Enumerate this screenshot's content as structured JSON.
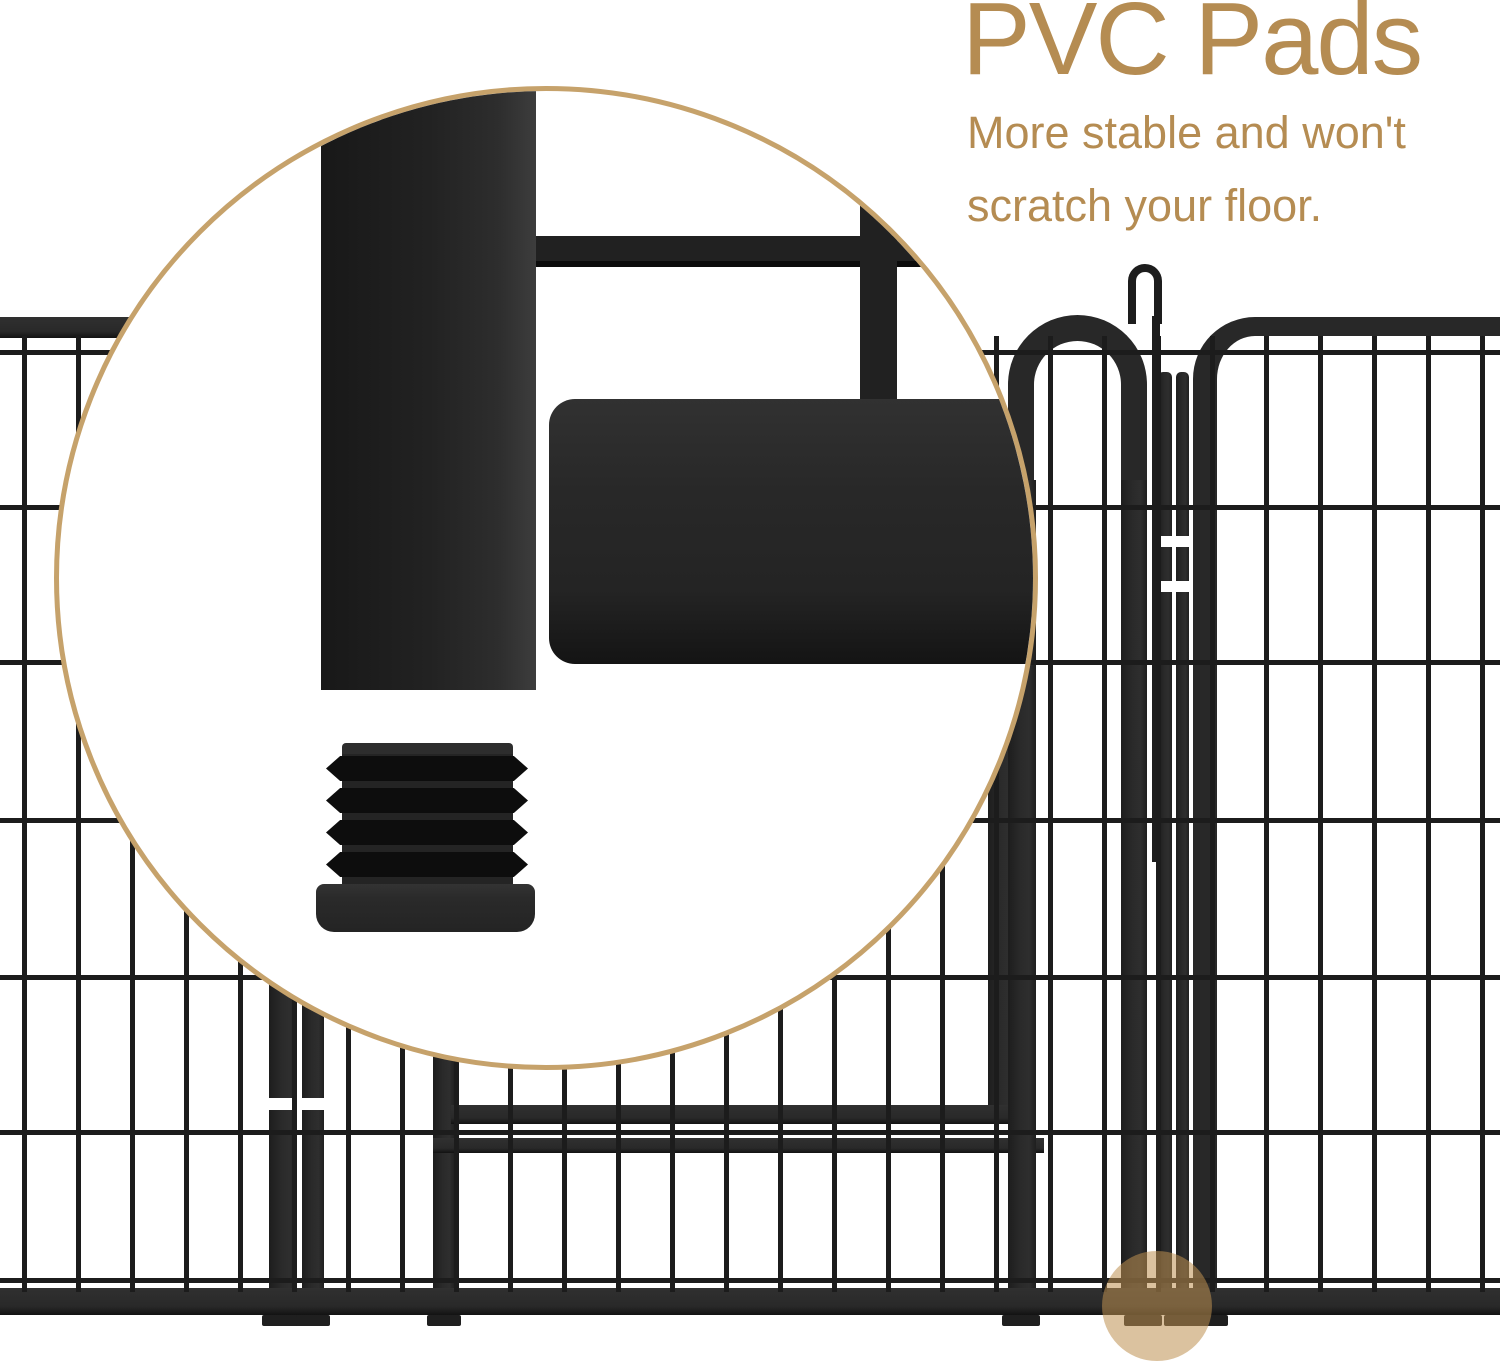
{
  "header": {
    "title": "PVC Pads",
    "subtitle": {
      "line1": "More stable and won't",
      "line2": "scratch your floor."
    }
  },
  "colors": {
    "accent_text": "#b58c52",
    "magnifier_ring": "#c6a26b",
    "metal_dark": "#272727",
    "wire": "#1c1c1c",
    "highlight_circle": "rgba(190,144,80,0.55)",
    "background": "#ffffff"
  }
}
